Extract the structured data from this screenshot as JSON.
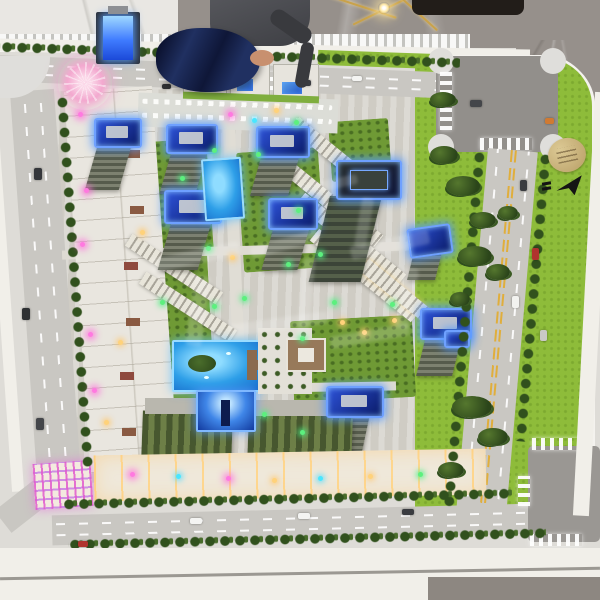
{
  "scene": {
    "title": "Overhead photo of an illuminated architectural scale model of a residential complex",
    "background": {
      "floor_label": "grey marble showroom floor",
      "person_label": "person leaning over the model holding a navy-blue cloth",
      "fixture_label": "gold wire light fixture"
    },
    "model": {
      "label": "miniature residential development on display table",
      "regions": {
        "perimeter_roads": "perimeter roads with white lane markings and street trees",
        "green_space": "bright green lawns with tree clusters",
        "towers": "high-rise towers with glowing blue rooftops",
        "pools": "illuminated blue swimming pools",
        "low_rise": "low-rise blocks and retail strips with colored lights",
        "plaza": "central landscaped plaza with pavilion",
        "watermark": "translucent illegible watermark overlay"
      },
      "markers": {
        "plaque": "gold circular site plaque, engraving illegible",
        "north_arrow": "black north-arrow symbol on lawn"
      }
    },
    "colors": {
      "grass": "#8ebc3a",
      "road": "#c9c7c2",
      "intersection": "#928f8b",
      "marble": "#96908b",
      "table_fascia": "#f1efe9",
      "glow_blue": "#4f8dff",
      "pool_blue": "#2e9fe8",
      "warm_light": "#ffd98c",
      "cloth_navy": "#203061"
    }
  }
}
